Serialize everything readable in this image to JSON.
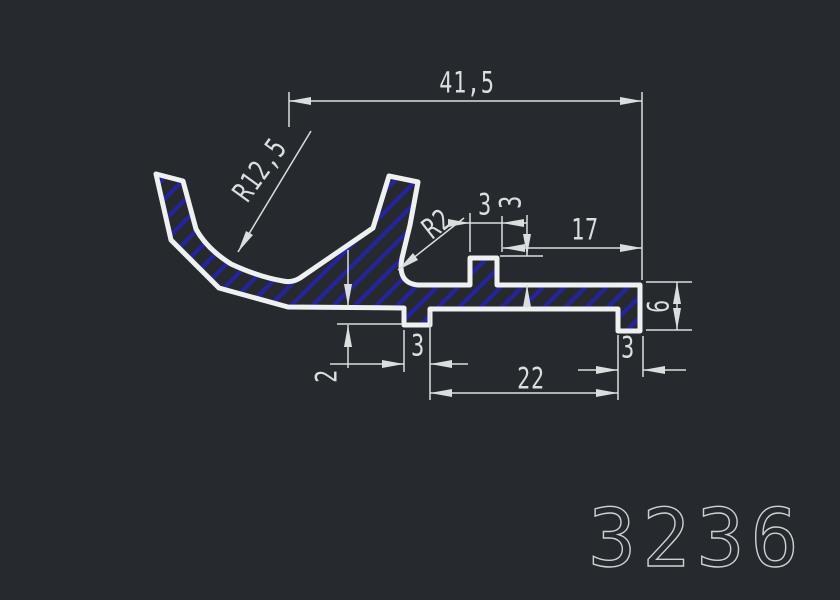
{
  "drawing": {
    "part_number": "3236",
    "labels": {
      "overall_width": "41,5",
      "inner_radius": "R12,5",
      "fillet_radius": "R2",
      "tab_width": "3",
      "tab_height": "3",
      "right_top_length": "17",
      "right_end_height": "6",
      "foot_depth": "2",
      "left_foot_width": "3",
      "feet_span": "22",
      "right_foot_width": "3"
    },
    "colors": {
      "background": "#262a2e",
      "profile_line": "#eff1f1",
      "hatch": "#2424a0",
      "dimension_line": "#d9dede",
      "part_number_color": "#ccd2d2"
    }
  }
}
